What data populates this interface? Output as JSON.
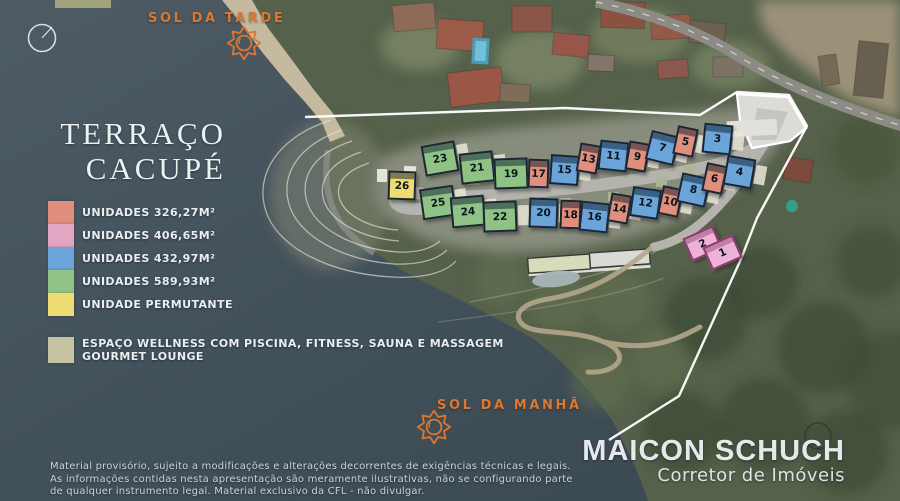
{
  "title": {
    "line1": "TERRAÇO",
    "line2": "CACUPÉ"
  },
  "sun": {
    "afternoon": {
      "label": "SOL DA TARDE"
    },
    "morning": {
      "label": "SOL DA MANHÃ"
    }
  },
  "colors": {
    "accent_orange": "#dd7730",
    "water": "#43515a",
    "land": "#55614a",
    "boundary": "#ffffff",
    "road": "#b5b3ae"
  },
  "legend": {
    "items": [
      {
        "color": "#df8f7b",
        "label": "UNIDADES 326,27M²",
        "type": "salmon"
      },
      {
        "color": "#e2a6c3",
        "label": "UNIDADES 406,65M²",
        "type": "pink"
      },
      {
        "color": "#6ba4d8",
        "label": "UNIDADES 432,97M²",
        "type": "blue"
      },
      {
        "color": "#8fc386",
        "label": "UNIDADES 589,93M²",
        "type": "green"
      },
      {
        "color": "#eedc72",
        "label": "UNIDADE PERMUTANTE",
        "type": "yellow"
      }
    ],
    "wellness": {
      "color": "#c5c3a1",
      "line1": "ESPAÇO WELLNESS COM PISCINA, FITNESS, SAUNA E MASSAGEM",
      "line2": "GOURMET LOUNGE"
    }
  },
  "unit_types": {
    "green": {
      "color": "#8fc386",
      "w": 34,
      "h": 31
    },
    "blue": {
      "color": "#6ba4d8",
      "w": 29,
      "h": 30
    },
    "salmon": {
      "color": "#df8f7b",
      "w": 21,
      "h": 29
    },
    "yellow": {
      "color": "#eedc72",
      "w": 28,
      "h": 29
    },
    "pink": {
      "color": "#edb3d7",
      "w": 33,
      "h": 25
    }
  },
  "units": [
    {
      "n": "23",
      "type": "green",
      "x": 423,
      "y": 143,
      "r": -10
    },
    {
      "n": "21",
      "type": "green",
      "x": 460,
      "y": 152,
      "r": -6
    },
    {
      "n": "19",
      "type": "green",
      "x": 494,
      "y": 158,
      "r": -2
    },
    {
      "n": "17",
      "type": "salmon",
      "x": 528,
      "y": 159,
      "r": 2
    },
    {
      "n": "15",
      "type": "blue",
      "x": 550,
      "y": 155,
      "r": 4
    },
    {
      "n": "13",
      "type": "salmon",
      "x": 578,
      "y": 144,
      "r": 10
    },
    {
      "n": "11",
      "type": "blue",
      "x": 599,
      "y": 141,
      "r": 6
    },
    {
      "n": "9",
      "type": "salmon",
      "x": 627,
      "y": 142,
      "r": 10
    },
    {
      "n": "7",
      "type": "blue",
      "x": 648,
      "y": 133,
      "r": 14
    },
    {
      "n": "5",
      "type": "salmon",
      "x": 675,
      "y": 127,
      "r": 12
    },
    {
      "n": "3",
      "type": "blue",
      "x": 703,
      "y": 124,
      "r": 6
    },
    {
      "n": "26",
      "type": "yellow",
      "x": 388,
      "y": 171,
      "r": 2
    },
    {
      "n": "25",
      "type": "green",
      "x": 421,
      "y": 187,
      "r": -8
    },
    {
      "n": "24",
      "type": "green",
      "x": 451,
      "y": 196,
      "r": -5
    },
    {
      "n": "22",
      "type": "green",
      "x": 483,
      "y": 201,
      "r": -2
    },
    {
      "n": "20",
      "type": "blue",
      "x": 529,
      "y": 198,
      "r": 2
    },
    {
      "n": "18",
      "type": "salmon",
      "x": 560,
      "y": 200,
      "r": 2
    },
    {
      "n": "16",
      "type": "blue",
      "x": 580,
      "y": 202,
      "r": 6
    },
    {
      "n": "14",
      "type": "salmon",
      "x": 609,
      "y": 194,
      "r": 10
    },
    {
      "n": "12",
      "type": "blue",
      "x": 631,
      "y": 188,
      "r": 8
    },
    {
      "n": "10",
      "type": "salmon",
      "x": 660,
      "y": 187,
      "r": 12
    },
    {
      "n": "8",
      "type": "blue",
      "x": 679,
      "y": 175,
      "r": 12
    },
    {
      "n": "6",
      "type": "salmon",
      "x": 704,
      "y": 164,
      "r": 12
    },
    {
      "n": "4",
      "type": "blue",
      "x": 725,
      "y": 157,
      "r": 10
    },
    {
      "n": "2",
      "type": "pink",
      "x": 686,
      "y": 231,
      "r": -24
    },
    {
      "n": "1",
      "type": "pink",
      "x": 706,
      "y": 240,
      "r": -24
    }
  ],
  "disclaimer": {
    "lines": [
      "Material provisório, sujeito a modificações e alterações decorrentes de exigências técnicas e legais.",
      "As informações contidas nesta apresentação são meramente ilustrativas, não se configurando parte",
      "de qualquer instrumento legal. Material exclusivo da CFL - não divulgar."
    ]
  },
  "branding": {
    "name": "MAICON SCHUCH",
    "subtitle": "Corretor de Imóveis"
  }
}
